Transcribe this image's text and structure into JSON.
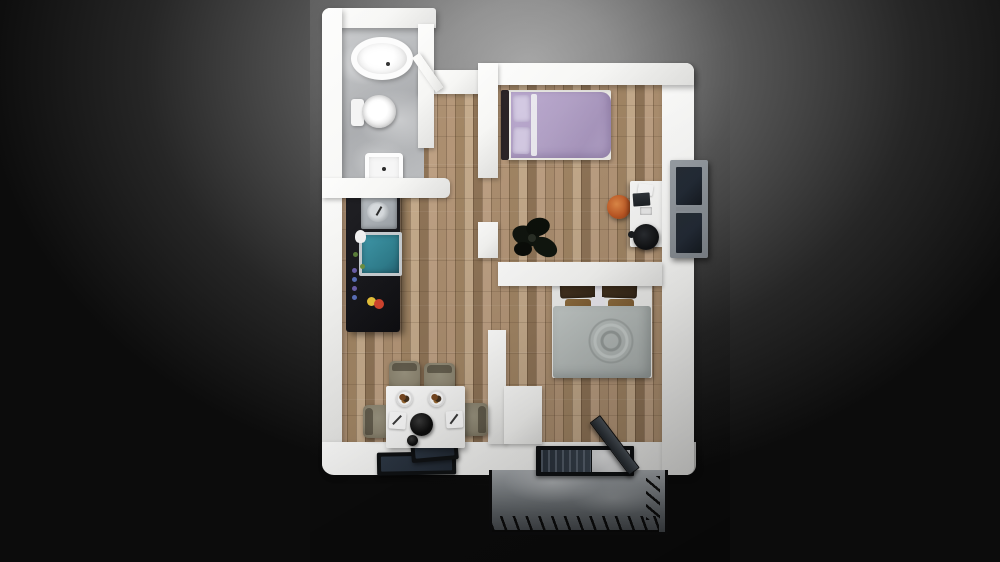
{
  "scene": {
    "type": "3d-floor-plan-render",
    "view": "top-down",
    "background": "dark radial vignette",
    "visible_text": ""
  },
  "rooms": {
    "bathroom": {
      "name": "Bathroom",
      "floor": "gray marble",
      "items": [
        "bathtub",
        "toilet",
        "sink",
        "open door"
      ]
    },
    "hallway": {
      "name": "Hallway",
      "floor": "wood planks",
      "items": []
    },
    "bedroom1": {
      "name": "Bedroom with single bed",
      "floor": "wood planks",
      "items": [
        "single bed purple",
        "desk",
        "office chair",
        "orange stool",
        "dark plant",
        "window"
      ]
    },
    "bedroom2": {
      "name": "Bedroom with double bed",
      "floor": "wood planks",
      "items": [
        "double bed gray"
      ]
    },
    "kitchen": {
      "name": "Kitchen",
      "floor": "wood planks",
      "items": [
        "black counter",
        "sink",
        "teal cooktop",
        "fruit"
      ]
    },
    "livingDining": {
      "name": "Living / Dining",
      "floor": "wood planks",
      "items": [
        "square table",
        "4 chairs",
        "place settings",
        "black bowl"
      ]
    },
    "balcony": {
      "name": "Balcony terrace",
      "floor": "marble",
      "items": [
        "black railing",
        "entry door",
        "dark glass panels"
      ]
    }
  },
  "furniture": {
    "bathtub": {
      "label": "Bathtub"
    },
    "toilet": {
      "label": "Toilet"
    },
    "bathSink": {
      "label": "Bathroom sink"
    },
    "kitchenCounter": {
      "label": "Kitchen counter"
    },
    "cooktop": {
      "label": "Teal cooktop"
    },
    "bedSingle": {
      "label": "Single bed with purple bedding"
    },
    "bedDouble": {
      "label": "Double bed with gray duvet"
    },
    "desk": {
      "label": "Desk with laptop"
    },
    "officeChair": {
      "label": "Office chair"
    },
    "stool": {
      "label": "Orange stool"
    },
    "plant": {
      "label": "Dark plant"
    },
    "diningTable": {
      "label": "Dining table with 4 settings"
    },
    "window": {
      "label": "Window on right wall"
    },
    "entryDoor": {
      "label": "Open entry door"
    },
    "balconyRailing": {
      "label": "Black balcony railing"
    }
  },
  "colors": {
    "bg-center": "#a6a6a6",
    "bg-mid": "#565656",
    "bg-edge": "#0c0c0c",
    "wall": "#f6f6f4",
    "wall-shade": "#e2e2e0",
    "wood-light": "#c4aa8b",
    "wood-mid": "#b49678",
    "wood-dark": "#8f7457",
    "marble-light": "#c6c8ca",
    "marble-mid": "#a9abae",
    "patio-light": "#a8acb0",
    "patio-dark": "#45494d",
    "counter-black": "#17171b",
    "cooktop-teal": "#3f97a8",
    "bed1-duvet": "#b2a1c6",
    "bed1-pillow": "#d3c9e2",
    "headboard-dark": "#2a2326",
    "bed2-duvet": "#b6bcba",
    "bed2-pillow-dark": "#352718",
    "bed2-pillow-tan": "#7d5c33",
    "chair-taupe": "#8d8672",
    "stool-orange": "#c05a26",
    "desk-white": "#f3f3f1",
    "chair-black": "#101113",
    "window-frame": "#80868c",
    "glass-dark": "#232b36",
    "railing-black": "#0d0d0e",
    "fruit-red": "#d2442e",
    "fruit-yellow": "#e8c23a"
  }
}
